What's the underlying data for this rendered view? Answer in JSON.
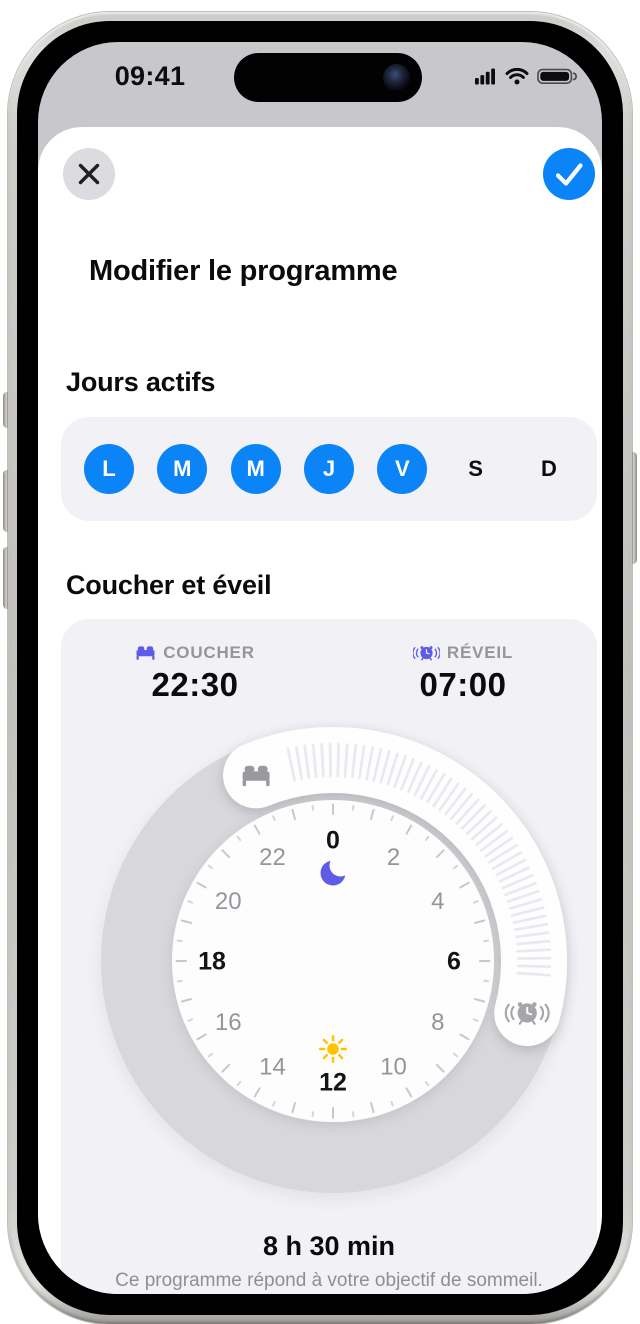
{
  "status_bar": {
    "time": "09:41",
    "icons": [
      "cellular-signal",
      "wifi",
      "battery-full"
    ]
  },
  "sheet": {
    "title": "Modifier le programme",
    "close_icon": "close-x",
    "confirm_icon": "checkmark"
  },
  "active_days": {
    "heading": "Jours actifs",
    "days": [
      {
        "label": "L",
        "selected": true
      },
      {
        "label": "M",
        "selected": true
      },
      {
        "label": "M",
        "selected": true
      },
      {
        "label": "J",
        "selected": true
      },
      {
        "label": "V",
        "selected": true
      },
      {
        "label": "S",
        "selected": false
      },
      {
        "label": "D",
        "selected": false
      }
    ]
  },
  "schedule": {
    "heading": "Coucher et éveil",
    "bedtime": {
      "label": "COUCHER",
      "time": "22:30",
      "icon": "bed"
    },
    "wake": {
      "label": "RÉVEIL",
      "time": "07:00",
      "icon": "alarm"
    },
    "duration": "8 h 30 min",
    "note": "Ce programme répond à votre objectif de sommeil."
  },
  "dial": {
    "bed_hour": 22.5,
    "wake_hour": 7,
    "hour_labels": [
      0,
      2,
      4,
      6,
      8,
      10,
      12,
      14,
      16,
      18,
      20,
      22
    ],
    "emphasized_hours": [
      0,
      6,
      12,
      18
    ],
    "top_icon": "moon",
    "bottom_icon": "sun",
    "start_handle_icon": "bed",
    "end_handle_icon": "alarm"
  },
  "colors": {
    "accent_blue": "#0b84f8",
    "indigo": "#5e5ce6",
    "sun_yellow": "#ffc400",
    "ring_gray": "#d8d7dc",
    "card_gray": "#f2f1f6",
    "status_gray": "#c8c7cc",
    "face_white": "#fdfdfe",
    "arc_white": "#fefefe",
    "arc_tick_gray": "#e9e9ef",
    "number_gray": "#95959b",
    "number_black": "#141416",
    "text_gray": "#8e8e93",
    "label_gray": "#95959a",
    "handle_icon_gray": "#9a99a0"
  }
}
